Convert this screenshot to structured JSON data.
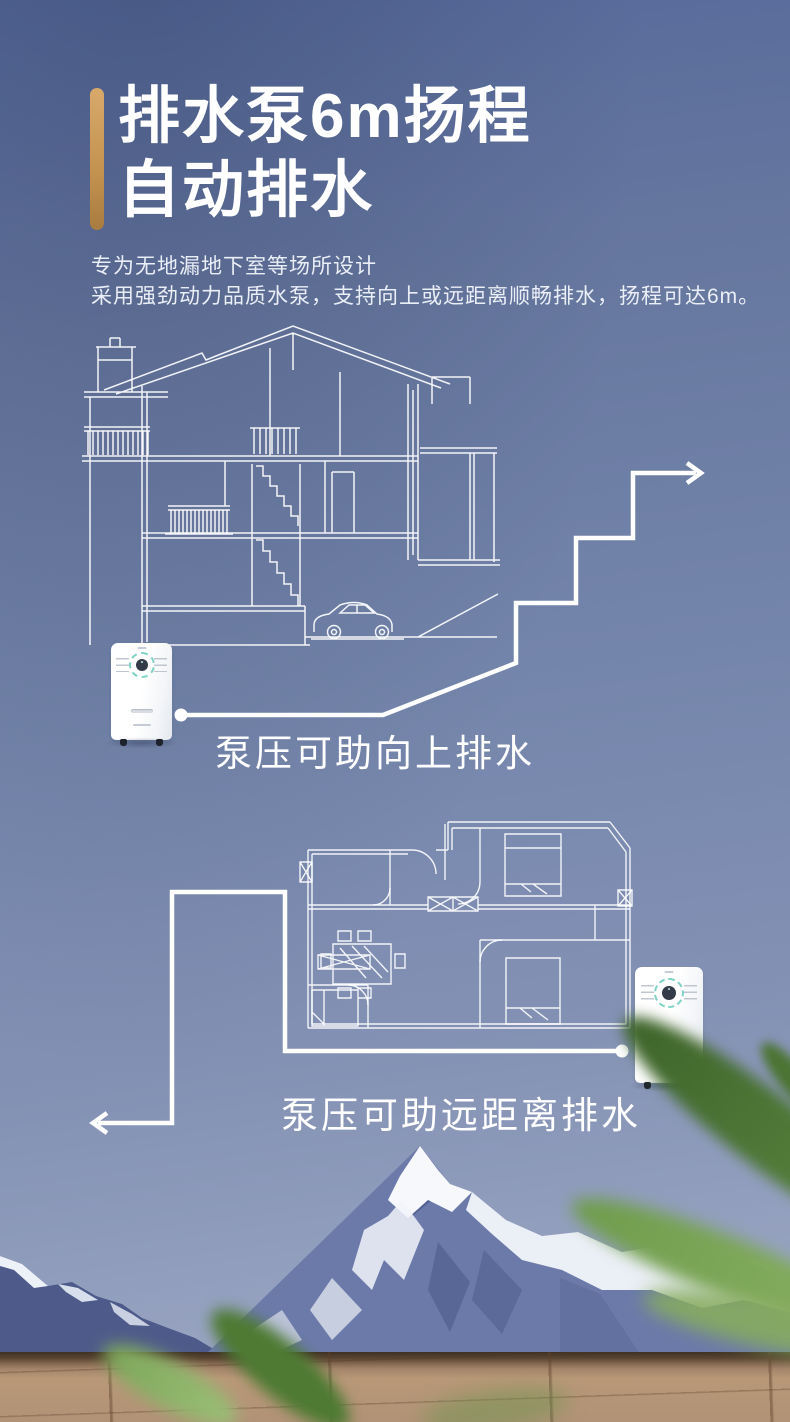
{
  "colors": {
    "bg_top": "#55689a",
    "bg_bottom": "#a6b0c8",
    "accent_gold": "#c3924f",
    "text_white": "#ffffff",
    "line_art_white": "#ffffff",
    "dial_teal": "#7fd3c6",
    "mountain_rock": "#6b7aa9",
    "mountain_shadow": "#4d5a8a",
    "snow_white": "#f4f6fb",
    "wood_brown": "#b19276",
    "leaf_green": "#5d8841"
  },
  "header": {
    "title_line1": "排水泵6m扬程",
    "title_line2": "自动排水",
    "subtitle_line1": "专为无地漏地下室等场所设计",
    "subtitle_line2": "采用强劲动力品质水泵，支持向上或远距离顺畅排水，扬程可达6m。"
  },
  "diagram_upward": {
    "caption": "泵压可助向上排水"
  },
  "diagram_distance": {
    "caption": "泵压可助远距离排水"
  }
}
